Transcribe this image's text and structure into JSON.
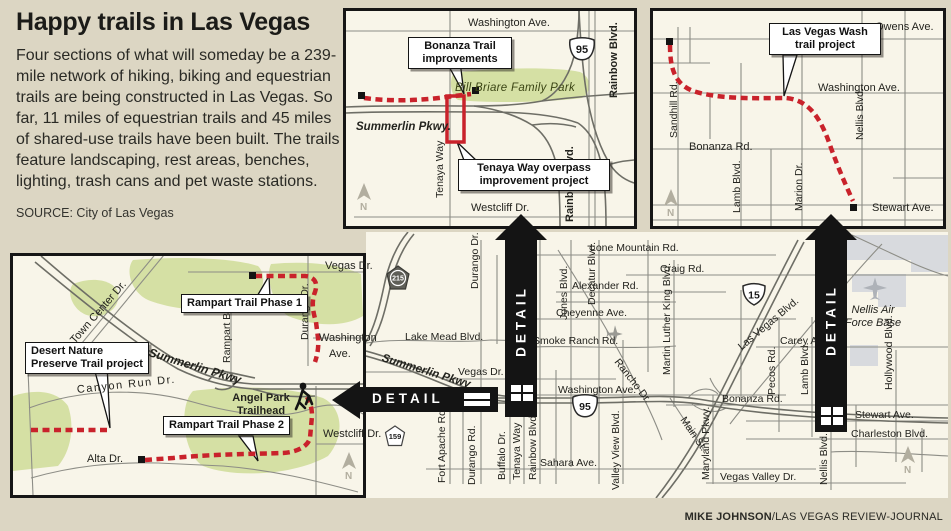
{
  "colors": {
    "page_bg": "#dcd6c3",
    "panel_bg": "#f8f5e9",
    "trail_red": "#c9222b",
    "park_green": "#d5e0a4",
    "road_gray": "#8d8d86",
    "freeway_gray": "#6e6e66",
    "detail_black": "#141414",
    "nellis_gray": "#d8dade",
    "compass_gray": "#b2ae9f"
  },
  "header": {
    "title": "Happy trails in Las Vegas",
    "intro": "Four sections of what will someday be a 239-mile network of hiking, biking and equestrian trails are being constructed in Las Vegas. So far, 11 miles of equestrian trails and 45 miles of shared-use trails have been built. The trails feature landscaping, rest areas, benches, lighting, trash cans and pet waste stations.",
    "source": "SOURCE: City of Las Vegas"
  },
  "credit": {
    "name": "MIKE JOHNSON",
    "publication": "/LAS VEGAS REVIEW-JOURNAL"
  },
  "detail_label": "DETAIL",
  "compass_n": "N",
  "bonanza_panel": {
    "callout_bonanza": "Bonanza Trail improvements",
    "callout_tenaya": "Tenaya Way overpass improvement project",
    "park_label": "Bill Briare Family Park",
    "shield_95": "95",
    "streets": {
      "washington": "Washington Ave.",
      "rainbow_top": "Rainbow Blvd.",
      "rainbow_bottom": "Rainbow Blvd.",
      "summerlin": "Summerlin Pkwy.",
      "tenaya": "Tenaya Way",
      "westcliff": "Westcliff Dr."
    }
  },
  "wash_panel": {
    "callout": "Las Vegas Wash trail project",
    "streets": {
      "owens": "Owens Ave.",
      "washington": "Washington Ave.",
      "sandhill": "Sandhill Rd.",
      "bonanza": "Bonanza Rd.",
      "lamb": "Lamb Blvd.",
      "marion": "Marion Dr.",
      "nellis": "Nellis Blvd.",
      "stewart": "Stewart Ave."
    }
  },
  "rampart_panel": {
    "callout_phase1": "Rampart Trail Phase 1",
    "callout_phase2": "Rampart Trail Phase 2",
    "callout_preserve": "Desert Nature Preserve Trail project",
    "trailhead_label": "Angel Park Trailhead",
    "streets": {
      "vegas": "Vegas Dr.",
      "town_center": "Town Center Dr.",
      "summerlin": "Summerlin Pkwy",
      "rampart": "Rampart Blvd.",
      "durango": "Durango Dr.",
      "washington_line1": "Washington",
      "washington_line2": "Ave.",
      "canyon_run": "Canyon Run Dr.",
      "westcliff": "Westcliff Dr.",
      "alta": "Alta Dr."
    }
  },
  "main_map": {
    "shields": {
      "route215": "215",
      "us95": "95",
      "i15": "15",
      "route159": "159"
    },
    "nellis_label": "Nellis Air Force Base",
    "streets": {
      "lone_mountain": "Lone Mountain Rd.",
      "craig": "Craig Rd.",
      "alexander": "Alexander Rd.",
      "cheyenne": "Cheyenne Ave.",
      "carey": "Carey Ave.",
      "smoke_ranch": "Smoke Ranch Rd.",
      "lake_mead": "Lake Mead Blvd.",
      "vegas": "Vegas Dr.",
      "washington": "Washington Ave.",
      "bonanza": "Bonanza Rd.",
      "stewart": "Stewart Ave.",
      "charleston": "Charleston Blvd.",
      "sahara": "Sahara Ave.",
      "vegas_valley": "Vegas Valley Dr.",
      "fort_apache": "Fort Apache Rd.",
      "durango_rd": "Durango Rd.",
      "buffalo": "Buffalo Dr.",
      "tenaya": "Tenaya Way",
      "rainbow": "Rainbow Blvd.",
      "jones": "Jones Blvd.",
      "decatur": "Decatur Blvd.",
      "valley_view": "Valley View Blvd.",
      "mlk": "Martin Luther King Blvd.",
      "maryland": "Maryland Pkwy.",
      "pecos": "Pecos Rd.",
      "lamb": "Lamb Blvd.",
      "nellis": "Nellis Blvd.",
      "hollywood": "Hollywood Blvd.",
      "durango_dr": "Durango Dr.",
      "summerlin": "Summerlin Pkwy",
      "rancho": "Rancho Dr.",
      "las_vegas": "Las Vegas Blvd.",
      "main_st": "Main St."
    }
  }
}
